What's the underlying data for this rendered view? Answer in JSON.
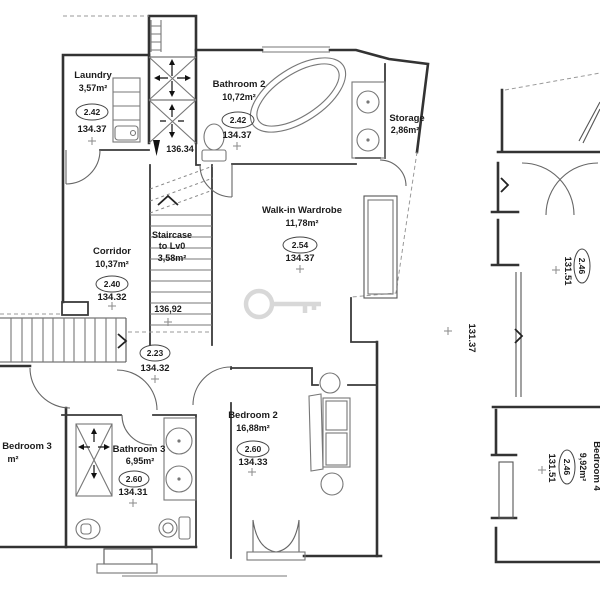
{
  "rooms": {
    "laundry": {
      "name": "Laundry",
      "area": "3,57m²",
      "ceiling": "2.42",
      "level": "134.37"
    },
    "bathroom2": {
      "name": "Bathroom 2",
      "area": "10,72m²",
      "ceiling": "2.42",
      "level": "134.37"
    },
    "storage": {
      "name": "Storage",
      "area": "2,86m²"
    },
    "walk_in_wardrobe": {
      "name": "Walk-in Wardrobe",
      "area": "11,78m²",
      "ceiling": "2.54",
      "level": "134.37"
    },
    "corridor": {
      "name": "Corridor",
      "area": "10,37m²",
      "ceiling": "2.40",
      "level": "134.32"
    },
    "staircase": {
      "name_line1": "Staircase",
      "name_line2": "to Lv0",
      "area": "3,58m²"
    },
    "landing": {
      "ceiling": "2.23",
      "level": "134.32"
    },
    "bedroom2": {
      "name": "Bedroom 2",
      "area": "16,88m²",
      "ceiling": "2.60",
      "level": "134.33"
    },
    "bathroom3": {
      "name": "Bathroom 3",
      "area": "6,95m²",
      "ceiling": "2.60",
      "level": "134.31"
    },
    "bedroom3_partial": {
      "name": "Bedroom 3",
      "area_unit": "m²"
    },
    "bedroom4": {
      "name": "Bedroom 4",
      "area": "9,92m²",
      "ceiling": "2.46",
      "level": "131.51"
    },
    "right_upper": {
      "ceiling": "2.46",
      "level": "131.51"
    }
  },
  "spot_levels": {
    "skylight_shaft": "136.34",
    "stair_head": "136,92",
    "section_mid": "131.37"
  },
  "colors": {
    "wall": "#333333",
    "fixture": "#777777",
    "text": "#1b1b1b",
    "dashed": "#999999",
    "watermark": "#d8d8d8",
    "background": "#ffffff"
  }
}
